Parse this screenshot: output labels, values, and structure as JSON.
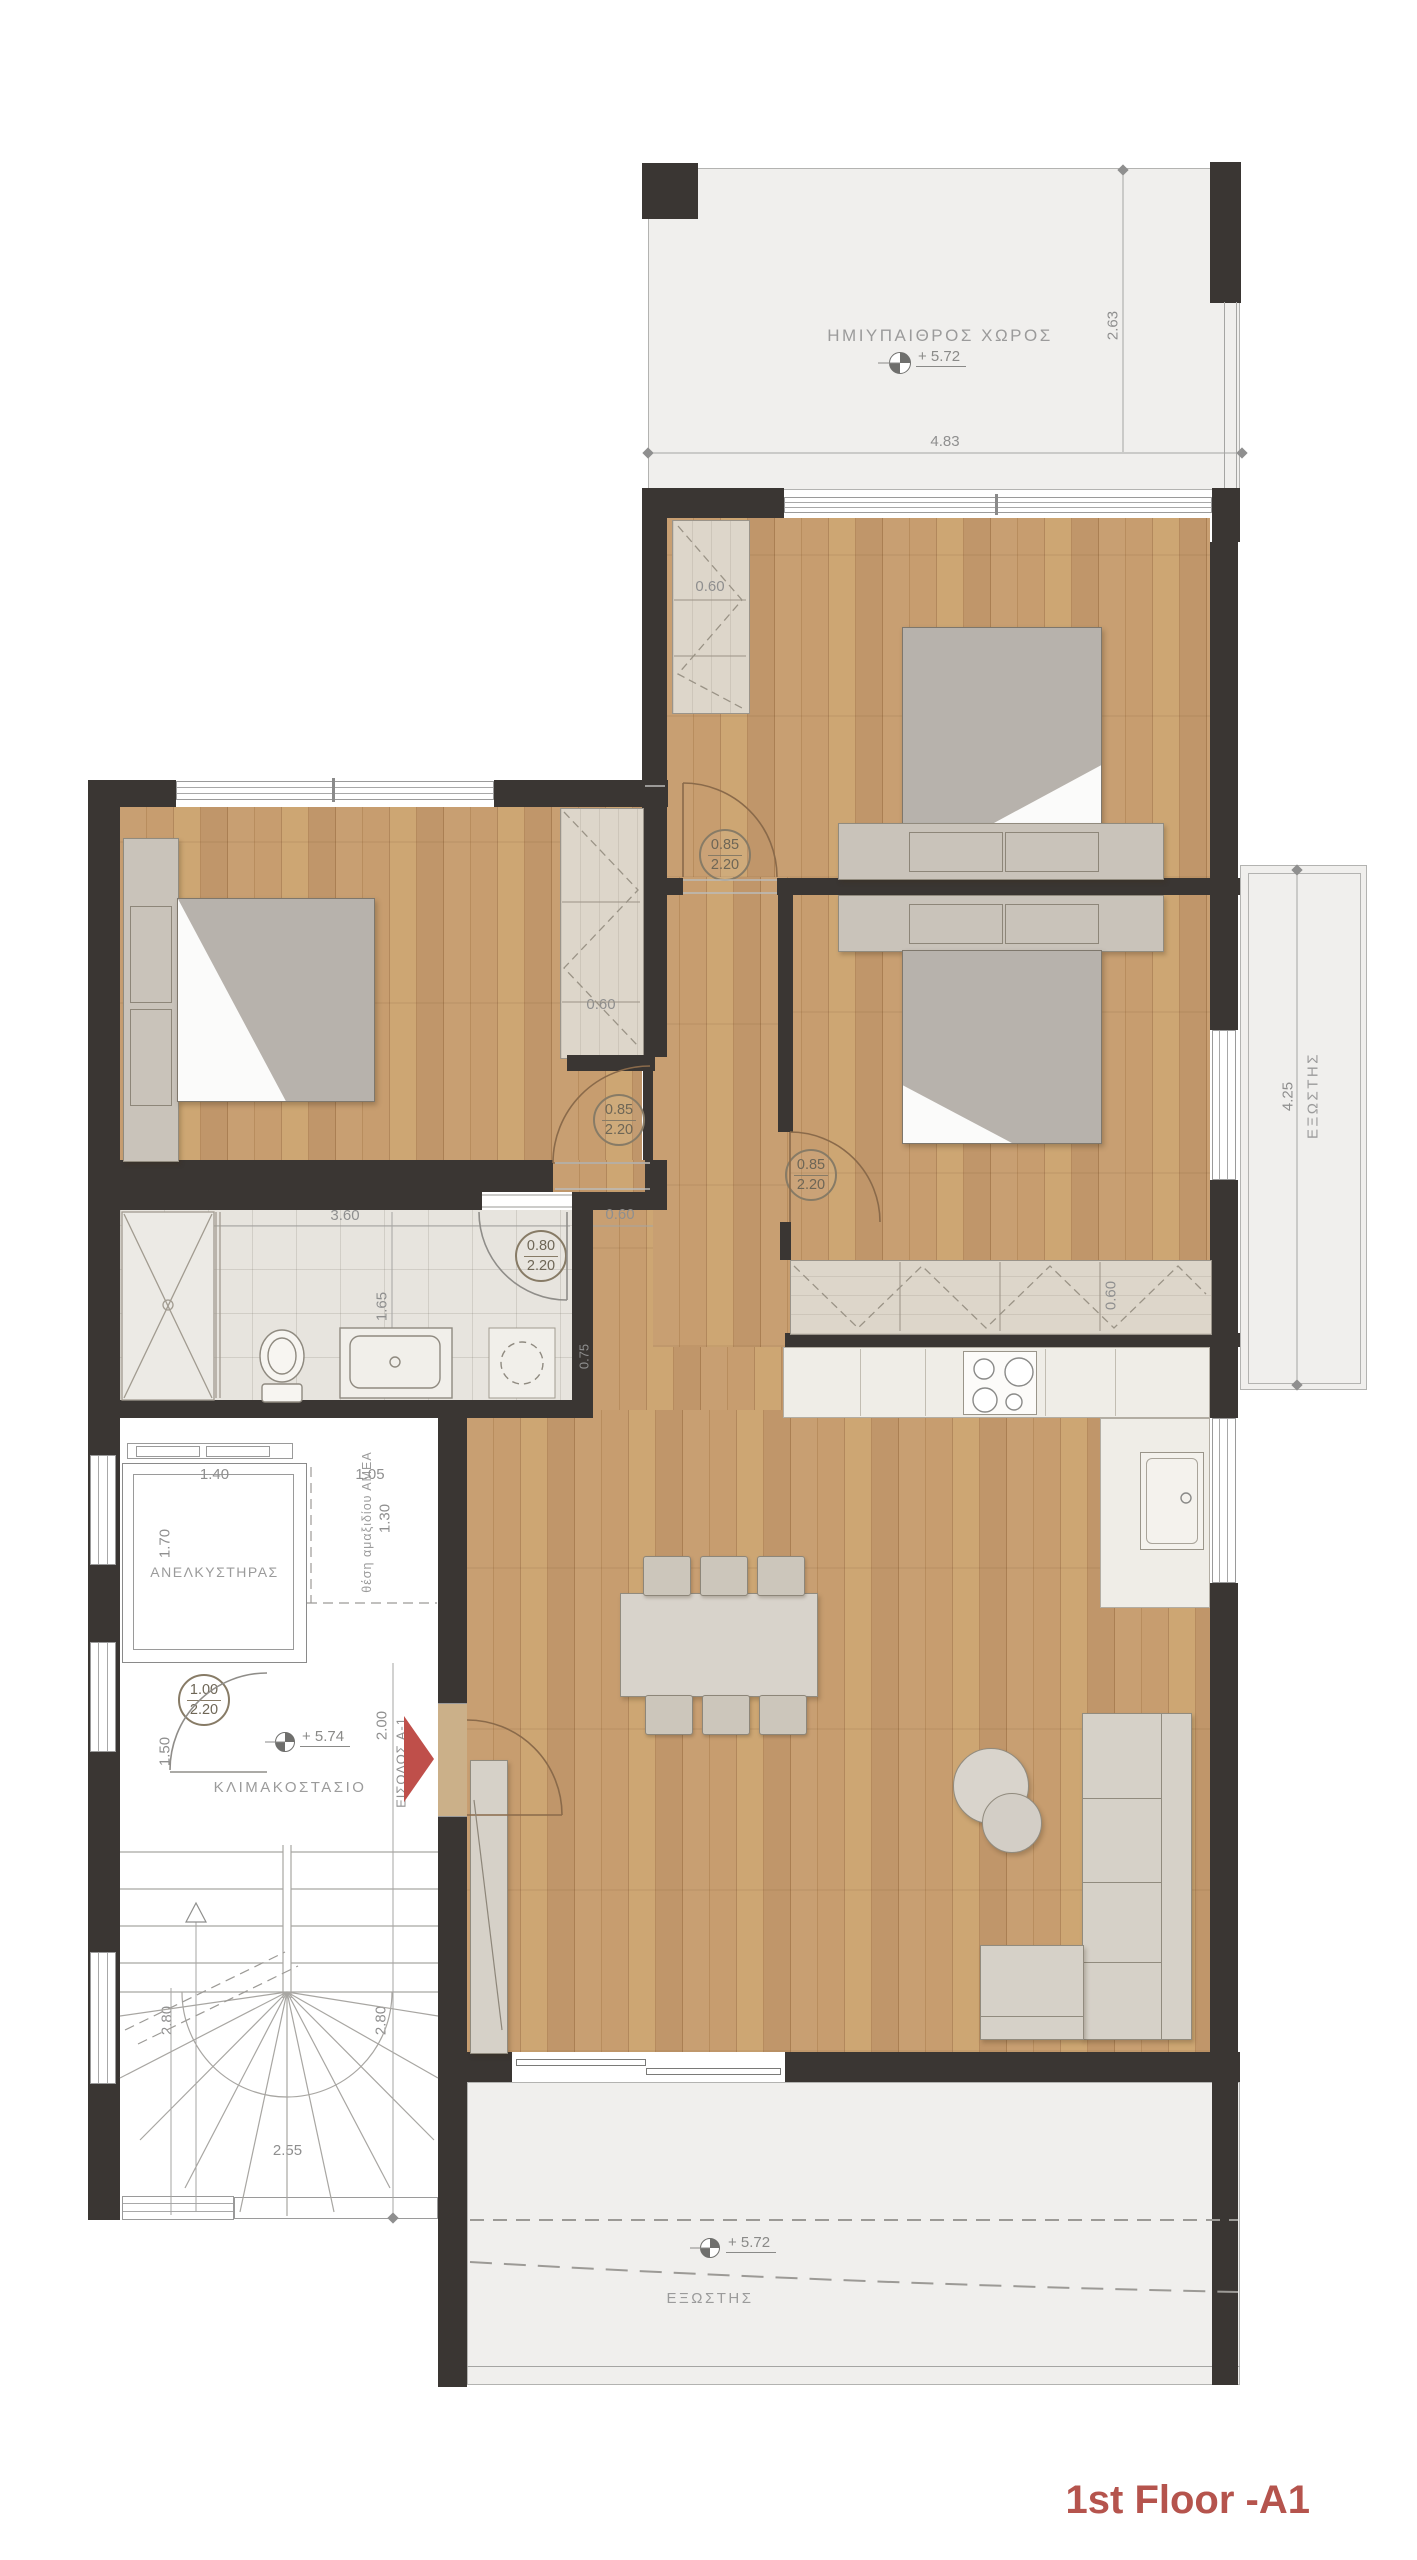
{
  "title": "1st Floor -A1",
  "rooms": {
    "semi_outdoor": "ΗΜΙΥΠΑΙΘΡΟΣ ΧΩΡΟΣ",
    "elevator": "ΑΝΕΛΚΥΣΤΗΡΑΣ",
    "stairwell": "ΚΛΙΜΑΚΟΣΤΑΣΙΟ",
    "balcony_bottom": "ΕΞΩΣΤΗΣ",
    "balcony_right": "ΕΞΩΣΤΗΣ",
    "wheelchair_space": "θέση αμαξιδίου ΑΜΕΑ",
    "entrance": "ΕΙΣΟΔΟΣ Α-1"
  },
  "levels": {
    "semi_outdoor": "+ 5.72",
    "stair_lobby": "+ 5.74",
    "balcony_bottom": "+ 5.72"
  },
  "door_tags": {
    "bedroom1": {
      "w": "0.85",
      "h": "2.20"
    },
    "bedroom_left": {
      "w": "0.85",
      "h": "2.20"
    },
    "bedroom2": {
      "w": "0.85",
      "h": "2.20"
    },
    "bathroom": {
      "w": "0.80",
      "h": "2.20"
    },
    "lobby": {
      "w": "1.00",
      "h": "2.20"
    }
  },
  "dimensions": {
    "semi_outdoor_depth": "2.63",
    "semi_outdoor_width": "4.83",
    "closet_bedroom1": "0.60",
    "closet_bedroom_left": "0.60",
    "wardrobe_bedroom2": "0.60",
    "hall_wall": "0.60",
    "bath_width": "3.60",
    "bath_depth": "1.65",
    "bath_wall": "0.75",
    "elevator_width": "1.40",
    "elevator_depth": "1.70",
    "wheelchair_width": "1.05",
    "wheelchair_depth": "1.30",
    "lobby_width": "1.50",
    "entry_depth": "2.00",
    "stair_flight_left": "2.80",
    "stair_flight_right": "2.80",
    "stair_width": "2.55",
    "balcony_right_length": "4.25"
  }
}
